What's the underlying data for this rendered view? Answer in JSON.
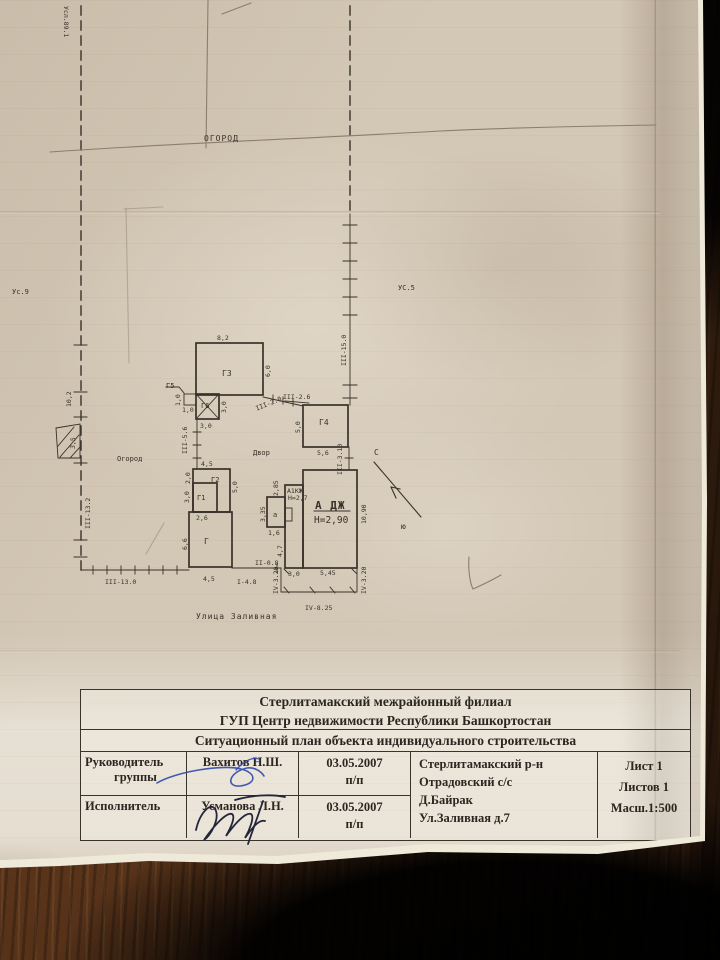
{
  "plan": {
    "areas": {
      "ogorod_top": "ОГОРОД",
      "ogorod_left": "Огород",
      "dvor": "Двор",
      "street": "Улица Заливная",
      "us5": "УС.5",
      "us9": "Ус.9",
      "usl": "Усл.89.1"
    },
    "north": {
      "n": "С",
      "s": "ю"
    },
    "buildings": {
      "g": "Г",
      "g1": "Г1",
      "g2": "Г2",
      "g3": "Г3",
      "g4": "Г4",
      "g5": "Г5",
      "g6": "Г6",
      "house": "А ДЖ",
      "house_h": "Н=2,90",
      "annex": "А1КЖ",
      "annex_h": "Н=2,7",
      "porch": "а"
    },
    "dims": {
      "g3_w": "8,2",
      "g3_h": "6,0",
      "g5_h": "1,0",
      "g5_w": "1,0",
      "g6_h": "3,0",
      "g6_w": "3,0",
      "left_102": "10,2",
      "left_35": "3,5",
      "g2_w": "4,5",
      "g2_hl": "2,0",
      "g2_hr": "5,0",
      "g1_h": "3,0",
      "g1_w": "2,6",
      "g_h": "6,6",
      "g_w": "4,5",
      "g4_h": "5,0",
      "g4_w": "5,6",
      "annex_t": "2,85",
      "porch_h": "3,35",
      "porch_w": "1,6",
      "annex_b": "4,7",
      "house_hr": "10,90",
      "house_w1": "3,0",
      "house_w2": "5,45"
    },
    "fences": {
      "f1": "I-4.8",
      "f2": "II-0.8",
      "f3_130": "III-13.0",
      "f3_132": "III-13.2",
      "f3_56": "III-5.6",
      "f3_20": "III-2.0",
      "f3_26": "III-2.6",
      "f3_150": "III-15.0",
      "f3_310": "III-3.10",
      "f4_l": "IV-3.20",
      "f4_r": "IV-3.20",
      "f4_b": "IV-8.25"
    }
  },
  "title_block": {
    "org_line1": "Стерлитамакский межрайонный филиал",
    "org_line2": "ГУП Центр недвижимости Республики Башкортостан",
    "doc_title": "Ситуационный план объекта индивидуального строительства",
    "rows": [
      {
        "role1": "Руководитель",
        "role2": "группы",
        "name": "Вахитов Н.Ш.",
        "date": "03.05.2007",
        "sign": "п/п"
      },
      {
        "role1": "Исполнитель",
        "role2": "",
        "name": "Усманова Л.Н.",
        "date": "03.05.2007",
        "sign": "п/п"
      }
    ],
    "location": [
      "Стерлитамакский р-н",
      "Отрадовский с/с",
      "Д.Байрак",
      "Ул.Заливная д.7"
    ],
    "sheet": [
      "Лист 1",
      "Листов 1",
      "Масш.1:500"
    ]
  }
}
